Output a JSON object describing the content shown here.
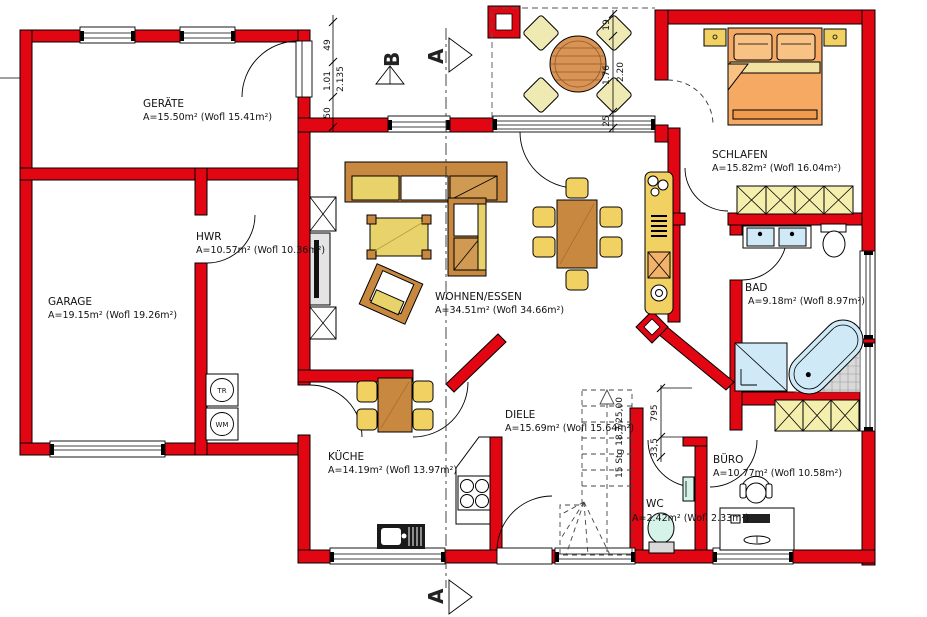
{
  "rooms": {
    "geraete": {
      "name": "GERÄTE",
      "area": "A=15.50m² (Wofl 15.41m²)"
    },
    "garage": {
      "name": "GARAGE",
      "area": "A=19.15m² (Wofl 19.26m²)"
    },
    "hwr": {
      "name": "HWR",
      "area": "A=10.57m² (Wofl 10.36m²)"
    },
    "wohnen": {
      "name": "WOHNEN/ESSEN",
      "area": "A=34.51m² (Wofl 34.66m²)"
    },
    "schlafen": {
      "name": "SCHLAFEN",
      "area": "A=15.82m² (Wofl 16.04m²)"
    },
    "bad": {
      "name": "BAD",
      "area": "A=9.18m² (Wofl 8.97m²)"
    },
    "kueche": {
      "name": "KÜCHE",
      "area": "A=14.19m² (Wofl 13.97m²)"
    },
    "diele": {
      "name": "DIELE",
      "area": "A=15.69m² (Wofl 15.64m²)"
    },
    "wc": {
      "name": "WC",
      "area": "A=2.42m² (Wofl 2.33m²)"
    },
    "buero": {
      "name": "BÜRO",
      "area": "A=10.77m² (Wofl 10.58m²)"
    }
  },
  "sections": {
    "a": "A",
    "b": "B"
  },
  "dims": {
    "d49": "49",
    "d101": "1.01",
    "d2135": "2.135",
    "d50": "50",
    "d19": "19",
    "d176": "1.76",
    "d220": "2.20",
    "d25": "25",
    "d795": "795",
    "d335": "33,5",
    "stairs_note": "15 Stg 18,7/25,00"
  },
  "appliances": {
    "tr": "TR",
    "wm": "WM"
  },
  "colors": {
    "wall_red": "#e20613",
    "furniture_yellow": "#f2d163",
    "wood_brown": "#c8883f",
    "bed_orange": "#f5a963",
    "closet_pale": "#f5efad",
    "fixture_blue": "#cfe9f7",
    "fixture_teal": "#d5f3e8"
  }
}
